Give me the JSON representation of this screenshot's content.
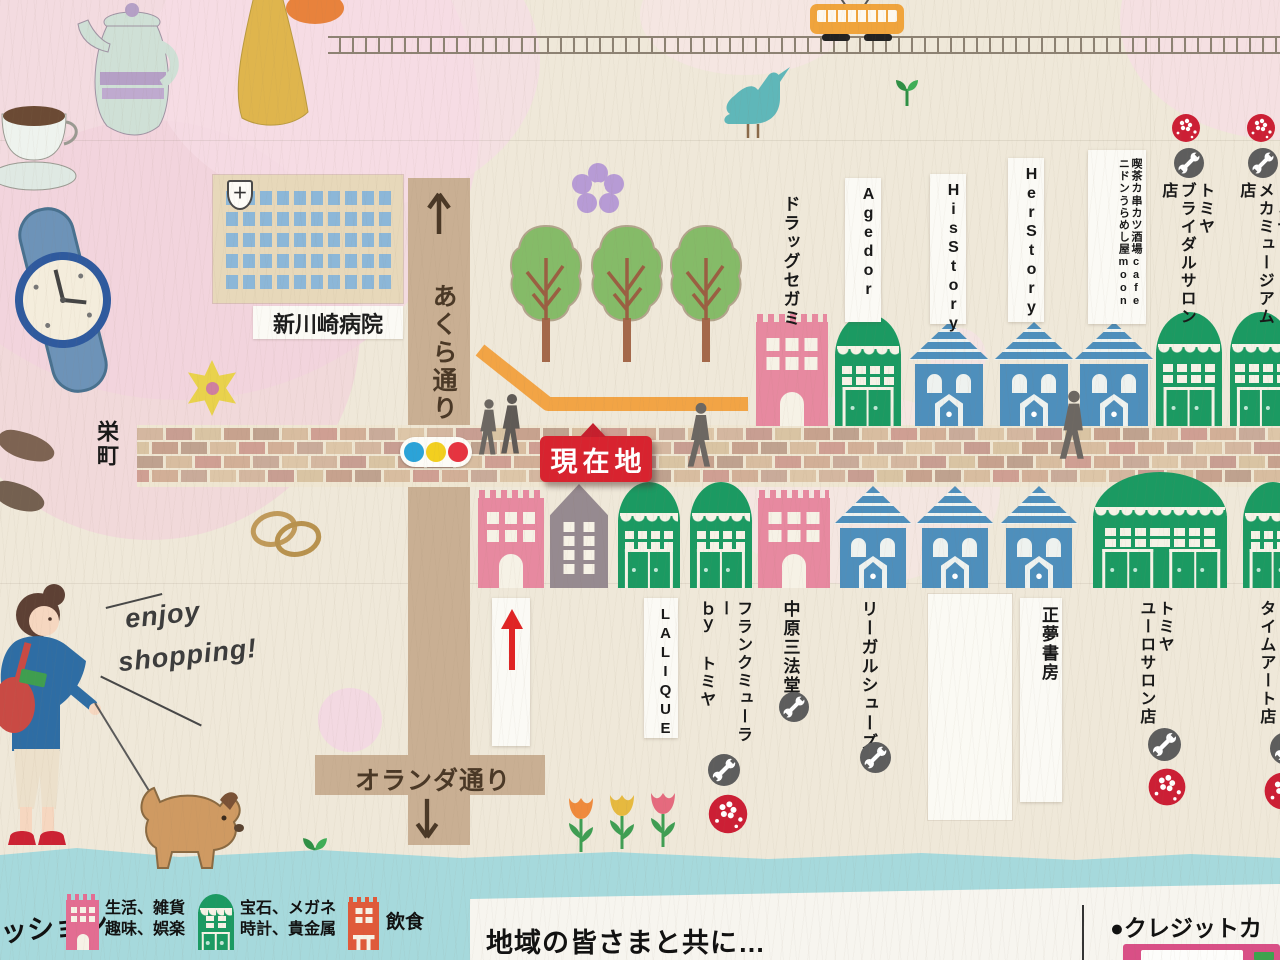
{
  "colors": {
    "paper": "#efe8d9",
    "accent_red": "#d8232f",
    "road_tan": "#c9af93",
    "teal_band": "#a6d9dc",
    "building_pink": "#e789a0",
    "building_green": "#1b9a62",
    "building_blue": "#4e8fbc",
    "building_gray": "#968a90",
    "path_orange": "#f2a445"
  },
  "landmarks": {
    "hospital_name": "新川崎病院",
    "hospital_cross": "＋",
    "current_location_label": "現在地",
    "note_line1": "enjoy",
    "note_line2": "shopping!"
  },
  "streets": {
    "vertical_street": "あくら通り",
    "horizontal_street": "オランダ通り",
    "district_label": "栄町"
  },
  "shops_north": [
    {
      "name": "ドラッグセガミ",
      "lines": [
        "ドラッグセガミ"
      ],
      "icons": []
    },
    {
      "name": "Agedor",
      "lines": [
        "Agedor"
      ],
      "icons": []
    },
    {
      "name": "HisStory",
      "lines": [
        "HisStory"
      ],
      "icons": []
    },
    {
      "name": "HerStory",
      "lines": [
        "HerStory"
      ],
      "icons": []
    },
    {
      "name": "喫茶カニドン 串カツ酒場うらめし屋 cafe moon",
      "lines": [
        "喫茶カニドン",
        "串カツ酒場うらめし屋",
        "cafe moon"
      ],
      "icons": []
    },
    {
      "name": "トミヤ ブライダルサロン店",
      "lines": [
        "トミヤ",
        "ブライダルサロン店"
      ],
      "icons": [
        "wrench",
        "sakura"
      ]
    },
    {
      "name": "トミヤ メカミュージアム店",
      "lines": [
        "トミヤ",
        "メカミュージアム店"
      ],
      "icons": [
        "wrench",
        "sakura"
      ]
    }
  ],
  "shops_south": [
    {
      "name": "LALIQUE",
      "lines": [
        "LALIQUE"
      ],
      "icons": []
    },
    {
      "name": "フランクミューラー by トミヤ",
      "lines": [
        "フランクミューラー",
        "ｂｙ トミヤ"
      ],
      "icons": [
        "wrench",
        "sakura"
      ]
    },
    {
      "name": "中原三法堂",
      "lines": [
        "中原三法堂"
      ],
      "icons": [
        "wrench"
      ]
    },
    {
      "name": "リーガルシューズ",
      "lines": [
        "リーガルシューズ"
      ],
      "icons": [
        "wrench"
      ]
    },
    {
      "name": "正夢書房",
      "lines": [
        "正夢書房"
      ],
      "icons": []
    },
    {
      "name": "トミヤ ユーロサロン店",
      "lines": [
        "トミヤ",
        "ユーロサロン店"
      ],
      "icons": [
        "wrench",
        "sakura"
      ]
    },
    {
      "name": "タイムアート店",
      "lines": [
        "タイムアート店"
      ],
      "icons": [
        "wrench",
        "sakura"
      ]
    }
  ],
  "legend": {
    "partial_text": "ッション",
    "items": [
      {
        "line1": "生活、雑貨",
        "line2": "趣味、娯楽"
      },
      {
        "line1": "宝石、メガネ",
        "line2": "時計、貴金属"
      },
      {
        "line1": "飲食",
        "line2": ""
      }
    ]
  },
  "footer": {
    "community_message": "地域の皆さまと共に…",
    "credit_heading": "●クレジットカー"
  }
}
